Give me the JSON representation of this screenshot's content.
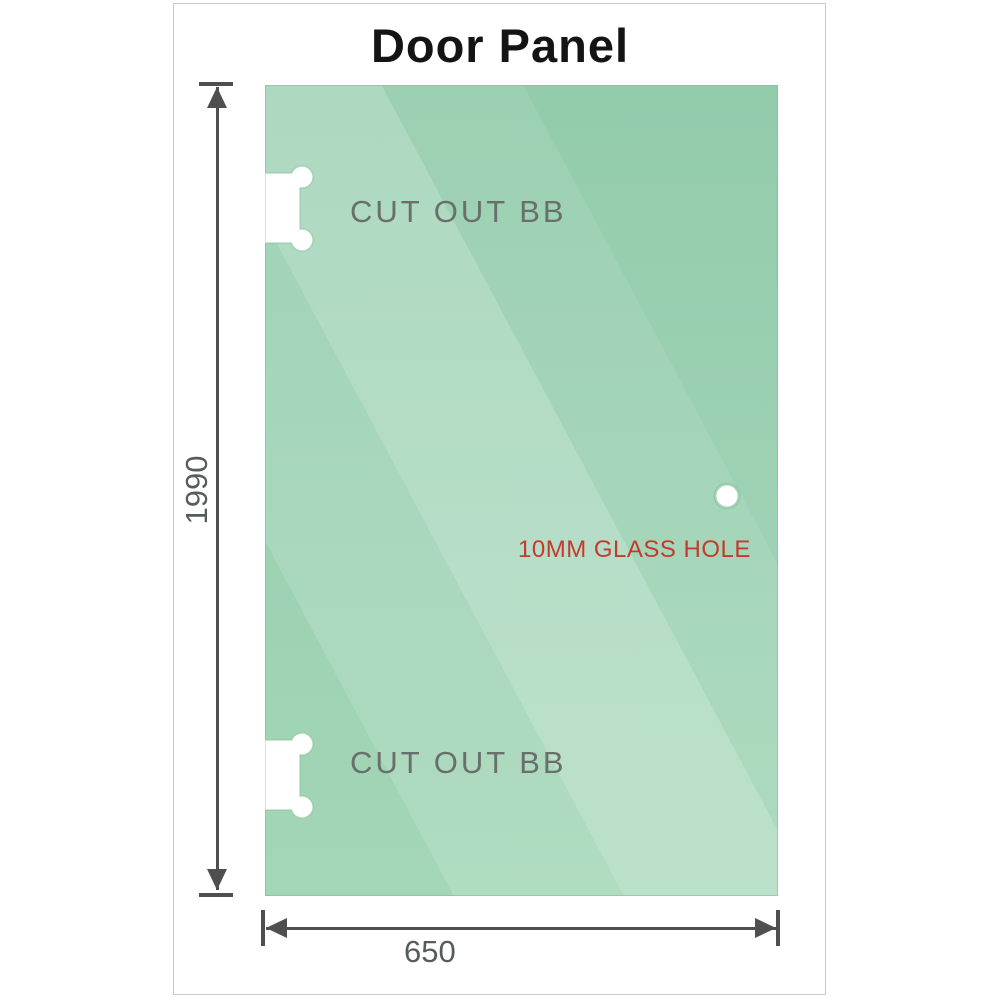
{
  "title": "Door Panel",
  "glass": {
    "cutout_top_label": "CUT OUT BB",
    "cutout_bottom_label": "CUT OUT BB",
    "hole_label": "10MM GLASS HOLE"
  },
  "dimensions": {
    "height": "1990",
    "width": "650"
  },
  "colors": {
    "glass_green": "#8fcaa8",
    "glass_highlight": "#b7e0c6",
    "hole_label_red": "#c43b2d",
    "dimension_gray": "#4f4f4f",
    "label_gray": "#696f6b",
    "frame_border": "#cbcbcb",
    "title_black": "#141414"
  }
}
